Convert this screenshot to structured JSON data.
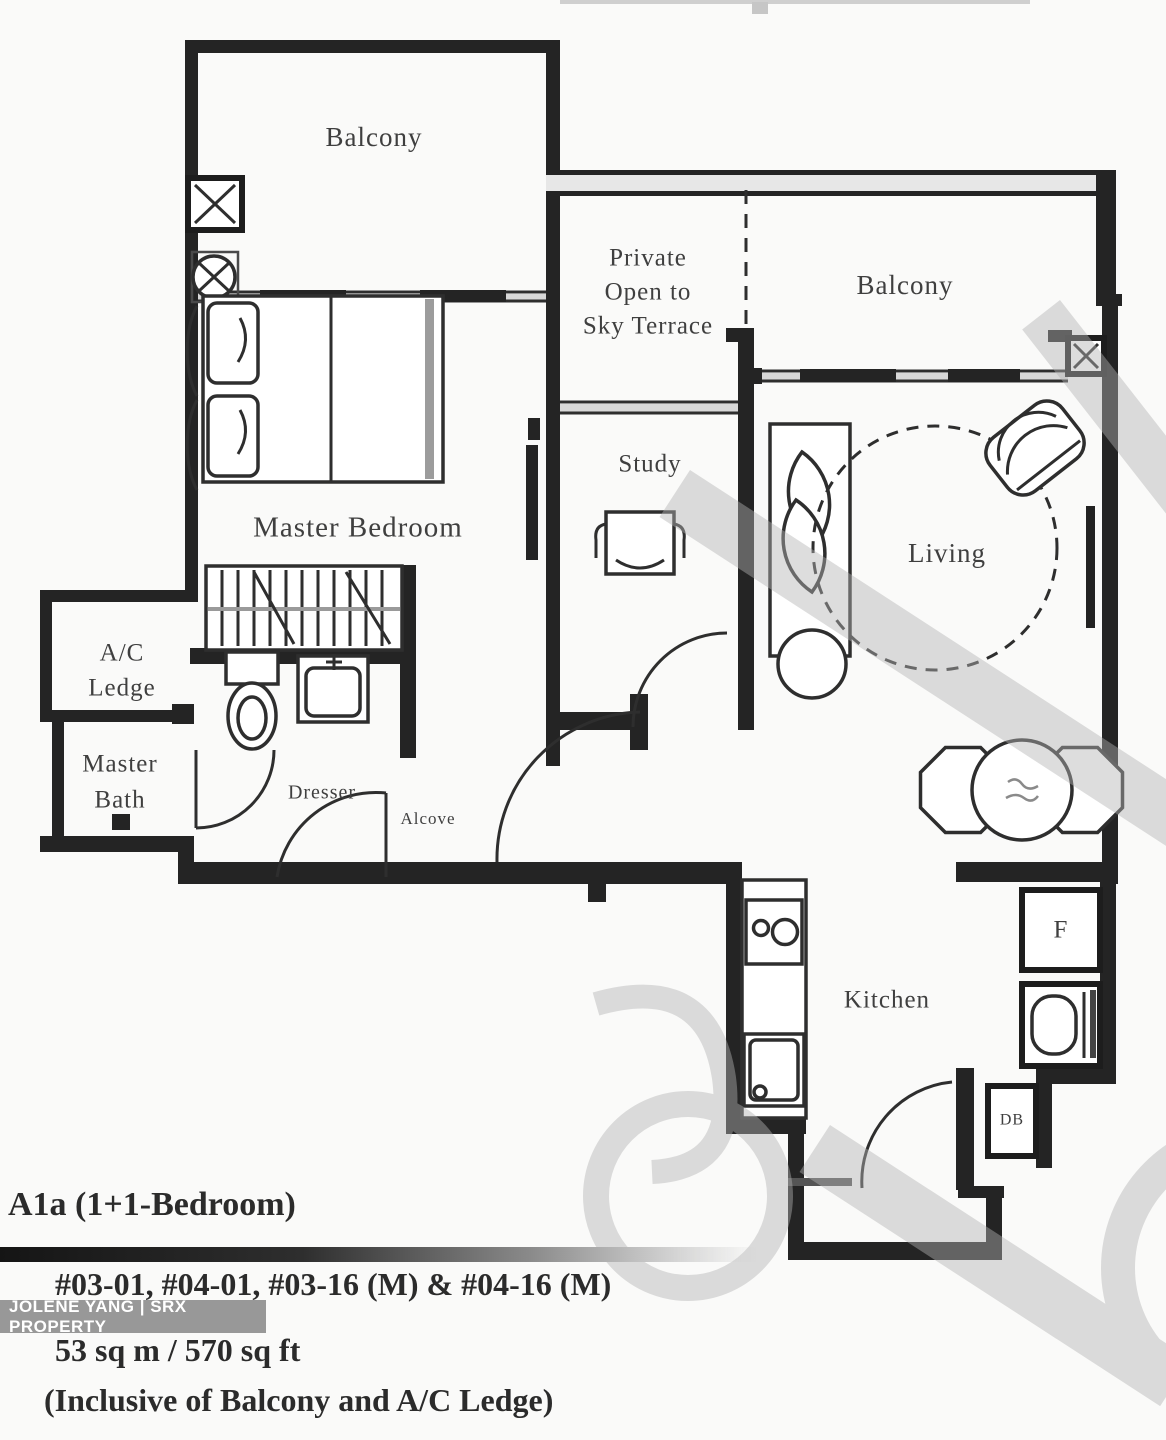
{
  "plan": {
    "rooms": {
      "balcony_top": "Balcony",
      "terrace_line1": "Private",
      "terrace_line2": "Open to",
      "terrace_line3": "Sky Terrace",
      "balcony_right": "Balcony",
      "master_bedroom": "Master Bedroom",
      "study": "Study",
      "living": "Living",
      "ac_line1": "A/C",
      "ac_line2": "Ledge",
      "bath_line1": "Master",
      "bath_line2": "Bath",
      "dresser": "Dresser",
      "alcove": "Alcove",
      "kitchen": "Kitchen"
    },
    "appliances": {
      "fridge": "F",
      "db": "DB"
    }
  },
  "footer": {
    "unit_type": "A1a (1+1-Bedroom)",
    "unit_numbers": "#03-01, #04-01, #03-16 (M) & #04-16 (M)",
    "area": "53 sq m / 570 sq ft",
    "area_note": "(Inclusive of Balcony and A/C Ledge)"
  },
  "watermark": {
    "agent": "JOLENE YANG | SRX PROPERTY"
  },
  "colors": {
    "wall": "#242424",
    "label": "#3f3f3f",
    "watermark": "#b4b4b4",
    "agent_band": "#8a8a8a",
    "footer_text": "#2b2b2b"
  }
}
